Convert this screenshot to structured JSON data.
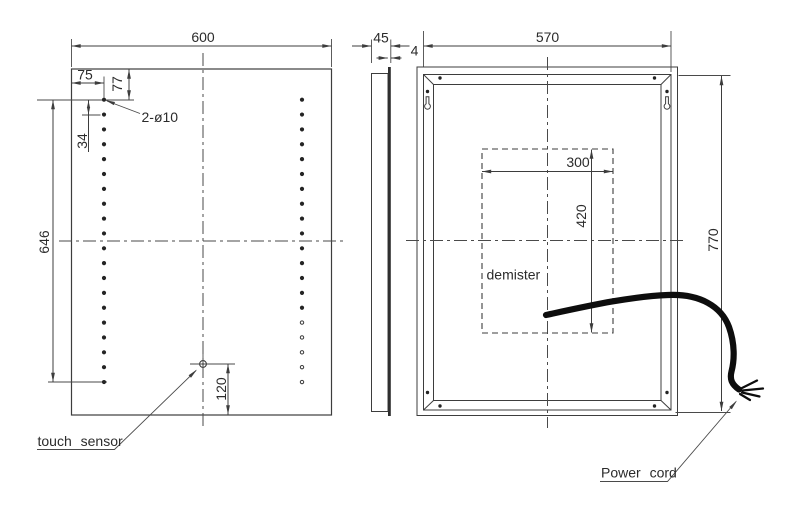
{
  "front_view": {
    "dim_width": "600",
    "dim_hole_inset_x": "75",
    "dim_hole_inset_y": "77",
    "dim_led_spacing": "34",
    "holes_label": "2-ø10",
    "dim_led_span": "646",
    "dim_sensor_offset": "120",
    "sensor_label": "touch sensor",
    "led_dots": {
      "left_col_x": 104,
      "right_col_x": 302,
      "top_y": 99.7,
      "spacing": 14.86,
      "count_per_column": 20,
      "right_hollow_count": 5,
      "filled_radius": 2.1,
      "hollow_radius": 1.7
    }
  },
  "side_view": {
    "dim_depth": "45",
    "dim_glass": "4"
  },
  "rear_view": {
    "dim_width": "570",
    "dim_height": "770",
    "demister": {
      "label": "demister",
      "dim_width": "300",
      "dim_height": "420"
    },
    "power_cord_label": "Power cord"
  },
  "colors": {
    "background": "#ffffff",
    "line": "#3d3d3d",
    "text": "#2b2b2b",
    "cord": "#0d0d0d"
  }
}
